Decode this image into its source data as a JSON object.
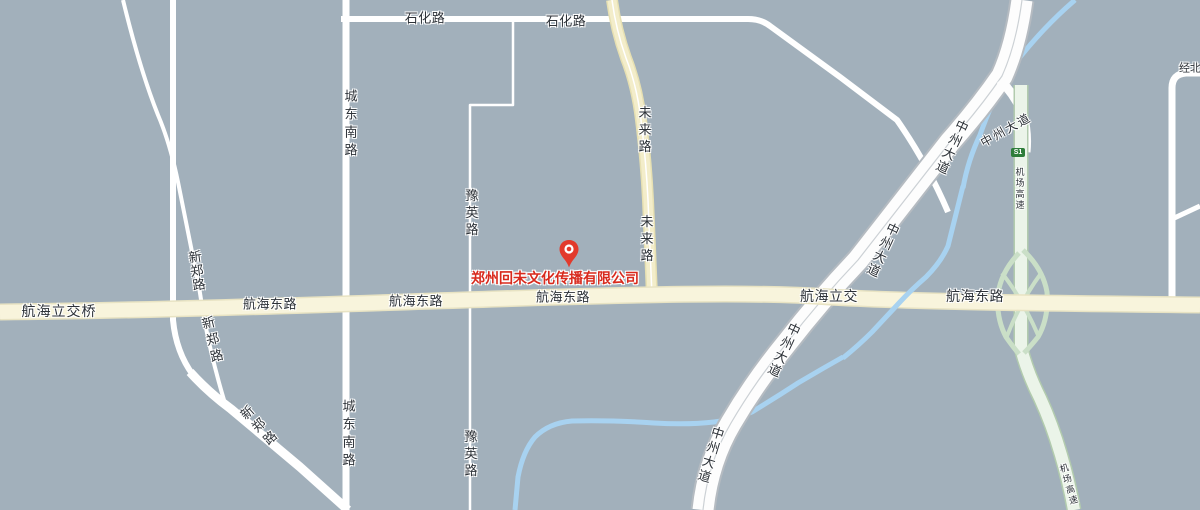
{
  "map": {
    "width": 1200,
    "height": 510,
    "background": "#a2b0bb",
    "colors": {
      "background": "#a2b0bb",
      "minor_road": "#ffffff",
      "arterial_fill": "#f8f4dc",
      "arterial_casing": "#e8e3c3",
      "yellow_road_fill": "#f3edca",
      "yellow_road_casing": "#e7e0b2",
      "highway_fill": "#fdfdfd",
      "highway_casing": "#b5bbc1",
      "expressway_fill": "#ebf4e9",
      "expressway_casing": "#b2cbae",
      "ramp": "#cadfc7",
      "river": "#a8d2f0",
      "label_text": "#2d3238",
      "company_red": "#d82a1d",
      "marker_red": "#e23a2c",
      "badge_green": "#2e7d3a"
    },
    "roads": [
      {
        "id": "river-upper-segment",
        "kind": "river",
        "d": "M1075,0 Q1040,30 1010,70 Q993,98 980,135 Q968,160 963,188",
        "stroke": "#a8d2f0",
        "width": 5
      },
      {
        "id": "river-lower-segment",
        "kind": "river",
        "d": "M843,357 Q820,370 798,383 Q775,398 752,412 Q734,420 714,422 Q688,425 654,423 Q610,420 572,421 Q549,423 535,437 Q523,451 518,477 L515,510",
        "stroke": "#a8d2f0",
        "width": 5
      },
      {
        "id": "road-shihua-lu",
        "kind": "minor",
        "d": "M341,19 L748,19 Q761,19 770,26 L840,77 L897,120 Q927,163 948,212",
        "stroke": "#ffffff",
        "width": 6
      },
      {
        "id": "road-chengdongnan-lu",
        "kind": "minor",
        "d": "M346,0 L346,510",
        "stroke": "#ffffff",
        "width": 7
      },
      {
        "id": "road-yuying-lu",
        "kind": "minor",
        "d": "M513,21 L513,105 L470,105 L470,510",
        "stroke": "#ffffff",
        "width": 2.5
      },
      {
        "id": "road-xinzheng-lu-north",
        "kind": "minor",
        "d": "M123,0 Q140,70 158,115 Q170,143 178,182 Q188,232 199,287 L204,318 Q212,360 224,400",
        "stroke": "#ffffff",
        "width": 4
      },
      {
        "id": "road-unnamed-vertical",
        "kind": "minor",
        "d": "M173,0 L173,320 Q176,352 193,375",
        "stroke": "#ffffff",
        "width": 6
      },
      {
        "id": "road-xinzheng-lu-southeast",
        "kind": "minor",
        "d": "M190,372 Q208,392 231,409 L300,467 L348,510",
        "stroke": "#ffffff",
        "width": 9
      },
      {
        "id": "road-northeast-corner",
        "kind": "minor",
        "d": "M1172,298 L1172,88 Q1172,74 1186,73 L1200,73",
        "stroke": "#ffffff",
        "width": 7
      },
      {
        "id": "road-northeast-branch",
        "kind": "minor",
        "d": "M1170,220 L1200,206",
        "stroke": "#ffffff",
        "width": 5
      },
      {
        "id": "road-weilai-lu-casing",
        "kind": "casing",
        "d": "M612,0 Q616,30 626,58 Q637,86 641,120 Q646,160 648,200 L652,296",
        "stroke": "#e7e0b2",
        "width": 12
      },
      {
        "id": "road-weilai-lu-fill",
        "kind": "fill",
        "d": "M612,0 Q616,30 626,58 Q637,86 641,120 Q646,160 648,200 L652,296",
        "stroke": "#f3edca",
        "width": 9
      },
      {
        "id": "road-weilai-lu-centerline",
        "kind": "line",
        "d": "M612,0 Q616,30 626,58 Q637,86 641,120 Q646,160 648,200 L652,296",
        "stroke": "#ffffff",
        "width": 1.5
      },
      {
        "id": "road-zhongzhou-dadao-casing",
        "kind": "casing",
        "d": "M1022,0 Q1016,45 1002,76 Q980,108 950,142 L858,260 Q820,300 786,344 Q755,382 731,423 Q708,462 703,510",
        "stroke": "#b5bbc1",
        "width": 25
      },
      {
        "id": "road-zhongzhou-dadao-fill",
        "kind": "fill",
        "d": "M1022,0 Q1016,45 1002,76 Q980,108 950,142 L858,260 Q820,300 786,344 Q755,382 731,423 Q708,462 703,510",
        "stroke": "#fdfdfd",
        "width": 21
      },
      {
        "id": "road-zhongzhou-dadao-centerline",
        "kind": "line",
        "d": "M1022,0 Q1016,45 1002,76 Q980,108 950,142 L858,260 Q820,300 786,344 Q755,382 731,423 Q708,462 703,510",
        "stroke": "#ccd1d5",
        "width": 1.2
      },
      {
        "id": "road-zhongzhou-branch-connector",
        "kind": "fill",
        "d": "M1000,80 Q1016,96 1023,115 Q1028,133 1026,152",
        "stroke": "#fdfdfd",
        "width": 9
      },
      {
        "id": "road-jichang-gaosu-casing",
        "kind": "casing",
        "d": "M1021,85 L1021,348 Q1027,372 1040,398 Q1052,424 1061,455 Q1069,482 1074,510",
        "stroke": "#b2cbae",
        "width": 15
      },
      {
        "id": "road-jichang-gaosu-fill",
        "kind": "fill",
        "d": "M1021,85 L1021,348 Q1027,372 1040,398 Q1052,424 1061,455 Q1069,482 1074,510",
        "stroke": "#ebf4e9",
        "width": 12
      },
      {
        "id": "interchange-ramp-east",
        "kind": "ramp",
        "d": "M1023,250 Q1043,269 1047,292 Q1049,318 1038,337 Q1030,347 1024,353",
        "stroke": "#cadfc7",
        "width": 5
      },
      {
        "id": "interchange-ramp-west",
        "kind": "ramp",
        "d": "M1019,253 Q1001,272 998,294 Q996,318 1006,337 Q1013,347 1019,354",
        "stroke": "#cadfc7",
        "width": 5
      },
      {
        "id": "interchange-ramp-cross-1",
        "kind": "ramp",
        "d": "M1042,272 Q1021,300 1007,336",
        "stroke": "#cadfc7",
        "width": 4
      },
      {
        "id": "interchange-ramp-cross-2",
        "kind": "ramp",
        "d": "M1002,273 Q1023,300 1038,335",
        "stroke": "#cadfc7",
        "width": 4
      },
      {
        "id": "road-hanghai-donglu-casing",
        "kind": "casing",
        "d": "M0,312 C200,310 420,301 560,297 C700,293 770,293 830,297 C900,301 1000,303 1200,305",
        "stroke": "#e8e3c3",
        "width": 17
      },
      {
        "id": "road-hanghai-donglu-fill",
        "kind": "fill",
        "d": "M0,312 C200,310 420,301 560,297 C700,293 770,293 830,297 C900,301 1000,303 1200,305",
        "stroke": "#f8f4dc",
        "width": 14
      },
      {
        "id": "river-middle-segment",
        "kind": "river",
        "d": "M963,186 Q955,218 948,246 Q941,262 926,277 Q911,290 899,303 Q887,316 872,332 Q859,345 843,358",
        "stroke": "#a8d2f0",
        "width": 5
      }
    ],
    "labels": [
      {
        "id": "label-shihua-lu-1",
        "text": "石化路",
        "x": 425,
        "y": 18,
        "size": 13,
        "dir": "h",
        "spacing": 0.5
      },
      {
        "id": "label-shihua-lu-2",
        "text": "石化路",
        "x": 566,
        "y": 21,
        "size": 13,
        "dir": "h",
        "spacing": 0.5
      },
      {
        "id": "label-chengdongnan-lu-1",
        "text": "城东南路",
        "x": 350,
        "y": 125,
        "size": 13,
        "dir": "v",
        "spacing": 5
      },
      {
        "id": "label-chengdongnan-lu-2",
        "text": "城东南路",
        "x": 348,
        "y": 435,
        "size": 13,
        "dir": "v",
        "spacing": 5
      },
      {
        "id": "label-yuying-lu-1",
        "text": "豫英路",
        "x": 471,
        "y": 214,
        "size": 13,
        "dir": "v",
        "spacing": 4
      },
      {
        "id": "label-yuying-lu-2",
        "text": "豫英路",
        "x": 470,
        "y": 455,
        "size": 13,
        "dir": "v",
        "spacing": 4
      },
      {
        "id": "label-weilai-lu-1",
        "text": "未来路",
        "x": 644,
        "y": 131,
        "size": 13,
        "dir": "v",
        "spacing": 4
      },
      {
        "id": "label-weilai-lu-2",
        "text": "未来路",
        "x": 646,
        "y": 240,
        "size": 13,
        "dir": "v",
        "spacing": 4
      },
      {
        "id": "label-xinzheng-lu-1",
        "text": "新郑路",
        "x": 196,
        "y": 271,
        "size": 13,
        "dir": "v",
        "rot": -8,
        "spacing": 1
      },
      {
        "id": "label-xinzheng-lu-2",
        "text": "新郑路",
        "x": 212,
        "y": 341,
        "size": 13,
        "dir": "v",
        "rot": -14,
        "spacing": 4
      },
      {
        "id": "label-xinzheng-lu-3",
        "text": "新郑路",
        "x": 259,
        "y": 427,
        "size": 13,
        "dir": "v",
        "rot": -42,
        "spacing": 4
      },
      {
        "id": "label-hanghai-lijiaoqiao",
        "text": "航海立交桥",
        "x": 59,
        "y": 311,
        "size": 14,
        "dir": "h",
        "spacing": 1
      },
      {
        "id": "label-hanghai-donglu-1",
        "text": "航海东路",
        "x": 270,
        "y": 304,
        "size": 13,
        "dir": "h",
        "spacing": 0.5
      },
      {
        "id": "label-hanghai-donglu-2",
        "text": "航海东路",
        "x": 416,
        "y": 301,
        "size": 13,
        "dir": "h",
        "spacing": 0.5
      },
      {
        "id": "label-hanghai-donglu-3",
        "text": "航海东路",
        "x": 563,
        "y": 297,
        "size": 13,
        "dir": "h",
        "spacing": 0.5
      },
      {
        "id": "label-hanghai-lijiao",
        "text": "航海立交",
        "x": 829,
        "y": 296,
        "size": 14,
        "dir": "h",
        "spacing": 0.5
      },
      {
        "id": "label-hanghai-donglu-4",
        "text": "航海东路",
        "x": 975,
        "y": 296,
        "size": 14,
        "dir": "h",
        "spacing": 0.5
      },
      {
        "id": "label-zhongzhou-dadao-1",
        "text": "中州大道",
        "x": 951,
        "y": 147,
        "size": 13,
        "dir": "v",
        "rot": 25,
        "spacing": 2
      },
      {
        "id": "label-zhongzhou-dadao-2",
        "text": "中州大道",
        "x": 882,
        "y": 250,
        "size": 13,
        "dir": "v",
        "rot": 25,
        "spacing": 2
      },
      {
        "id": "label-zhongzhou-dadao-3",
        "text": "中州大道",
        "x": 783,
        "y": 350,
        "size": 13,
        "dir": "v",
        "rot": 25,
        "spacing": 2
      },
      {
        "id": "label-zhongzhou-dadao-4",
        "text": "中州大道",
        "x": 710,
        "y": 455,
        "size": 13,
        "dir": "v",
        "rot": 17,
        "spacing": 2
      },
      {
        "id": "label-zhongzhou-dadao-branch",
        "text": "中州大道",
        "x": 1006,
        "y": 130,
        "size": 12,
        "dir": "h",
        "rot": -29,
        "spacing": 2
      },
      {
        "id": "label-jichang-gaosu-1",
        "text": "机场高速",
        "x": 1019,
        "y": 189,
        "size": 9,
        "dir": "v",
        "spacing": 2
      },
      {
        "id": "label-jichang-gaosu-2",
        "text": "机场高速",
        "x": 1068,
        "y": 485,
        "size": 9,
        "dir": "v",
        "rot": -16,
        "spacing": 2
      },
      {
        "id": "label-jingbei-road",
        "text": "经北",
        "x": 1190,
        "y": 69,
        "size": 11,
        "dir": "h",
        "spacing": 0
      },
      {
        "id": "company-label",
        "text": "郑州回未文化传播有限公司",
        "x": 555,
        "y": 278,
        "size": 14,
        "dir": "h",
        "color": "#d82a1d",
        "weight": 700,
        "spacing": 0,
        "interactable": true
      }
    ],
    "badge": {
      "id": "badge-s1",
      "text": "S1",
      "x": 1018,
      "y": 152,
      "background": "#2e7d3a"
    },
    "marker": {
      "name": "location-marker-icon",
      "x": 569,
      "tip_y": 268,
      "color": "#e23a2c"
    }
  }
}
